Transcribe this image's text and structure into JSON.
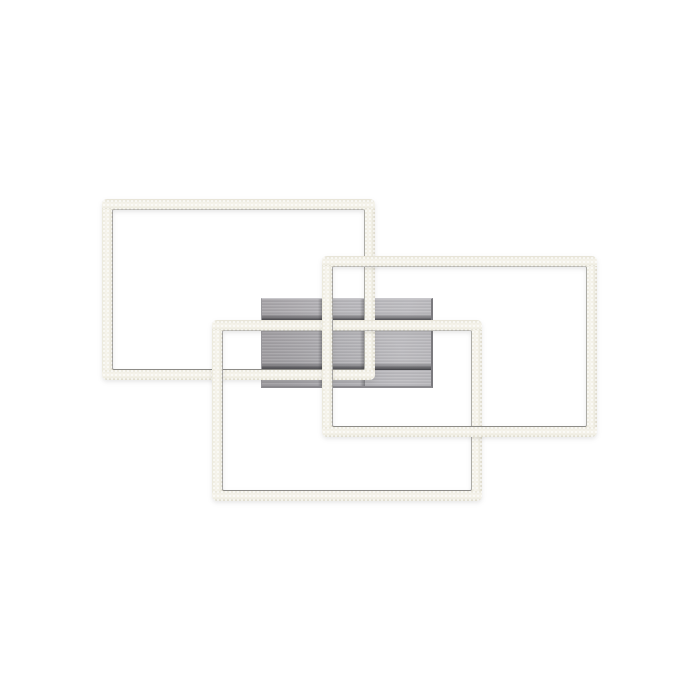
{
  "scene": {
    "description": "Product photo of a modern LED ceiling light: three overlapping rectangular warm-white LED frames mounted on a square brushed-aluminium canopy, photographed on a plain white background",
    "background": "#ffffff"
  },
  "colors": {
    "background": "#ffffff",
    "frame_base": "#f2f0e6",
    "frame_highlight": "#f7f5ee",
    "frame_edge_dark": "#ddd9cb",
    "frame_inner_line": "#7d7d7f",
    "plate_left": "#a4a1a5",
    "plate_mid": "#b7b6ba",
    "plate_right": "#bdbcc0",
    "plate_border_dark": "#7b7a7e",
    "plate_border_light": "#c9c8cc",
    "cast_shadow": "#3f3f43"
  },
  "plate": {
    "name": "mounting-plate",
    "x": 261,
    "y": 298,
    "w": 172,
    "h": 90,
    "shadows": [
      {
        "name": "cast-shadow-under-bottom-frame-top-bar",
        "type": "h",
        "x": 0,
        "y": 15,
        "w": 172,
        "h": 7
      },
      {
        "name": "cast-shadow-under-top-frame-bottom-bar",
        "type": "h",
        "x": 0,
        "y": 64,
        "w": 172,
        "h": 7
      },
      {
        "name": "cast-shadow-left-of-right-frame-left-bar",
        "type": "v",
        "x": 56,
        "y": 0,
        "w": 5,
        "h": 90
      },
      {
        "name": "cast-shadow-left-of-top-frame-right-bar",
        "type": "v",
        "x": 98,
        "y": 0,
        "w": 5,
        "h": 90
      }
    ]
  },
  "frames": [
    {
      "name": "led-frame-top-left",
      "x": 102,
      "y": 199,
      "w": 273,
      "h": 181,
      "thickness": 11
    },
    {
      "name": "led-frame-bottom-left",
      "x": 212,
      "y": 320,
      "w": 270,
      "h": 181,
      "thickness": 11
    },
    {
      "name": "led-frame-right",
      "x": 322,
      "y": 256,
      "w": 275,
      "h": 181,
      "thickness": 11
    }
  ]
}
